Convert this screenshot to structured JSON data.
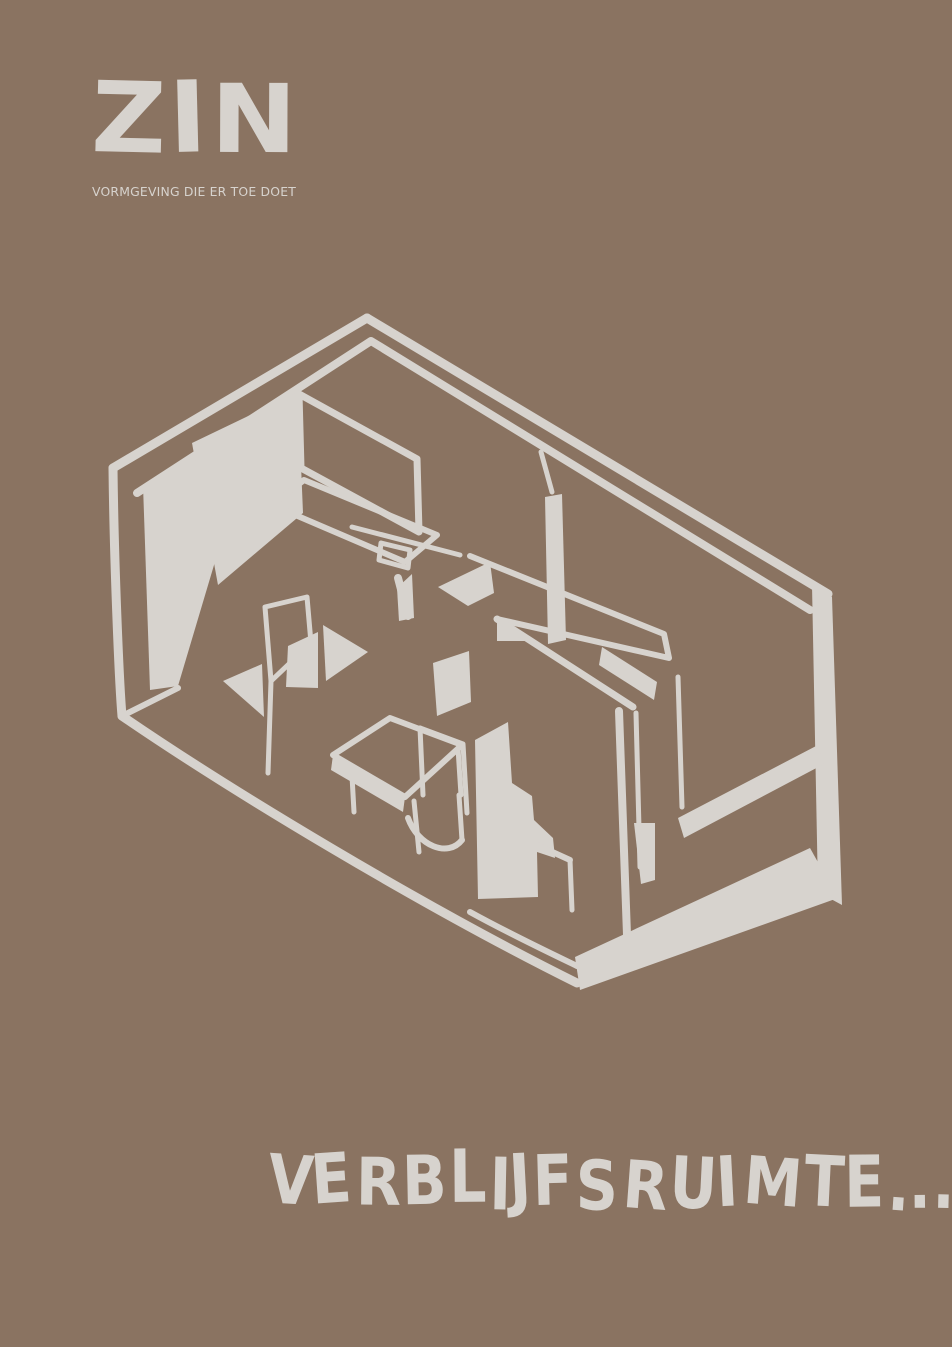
{
  "colors": {
    "background": "#8a7361",
    "ink": "#d7d3ce"
  },
  "brand": {
    "logo": "ZIN",
    "tagline": "VORMGEVING DIE ER TOE DOET"
  },
  "headline": {
    "text": "VERBLIJFSRUIMTE..."
  },
  "illustration": {
    "name": "isometric-room-sketch"
  }
}
